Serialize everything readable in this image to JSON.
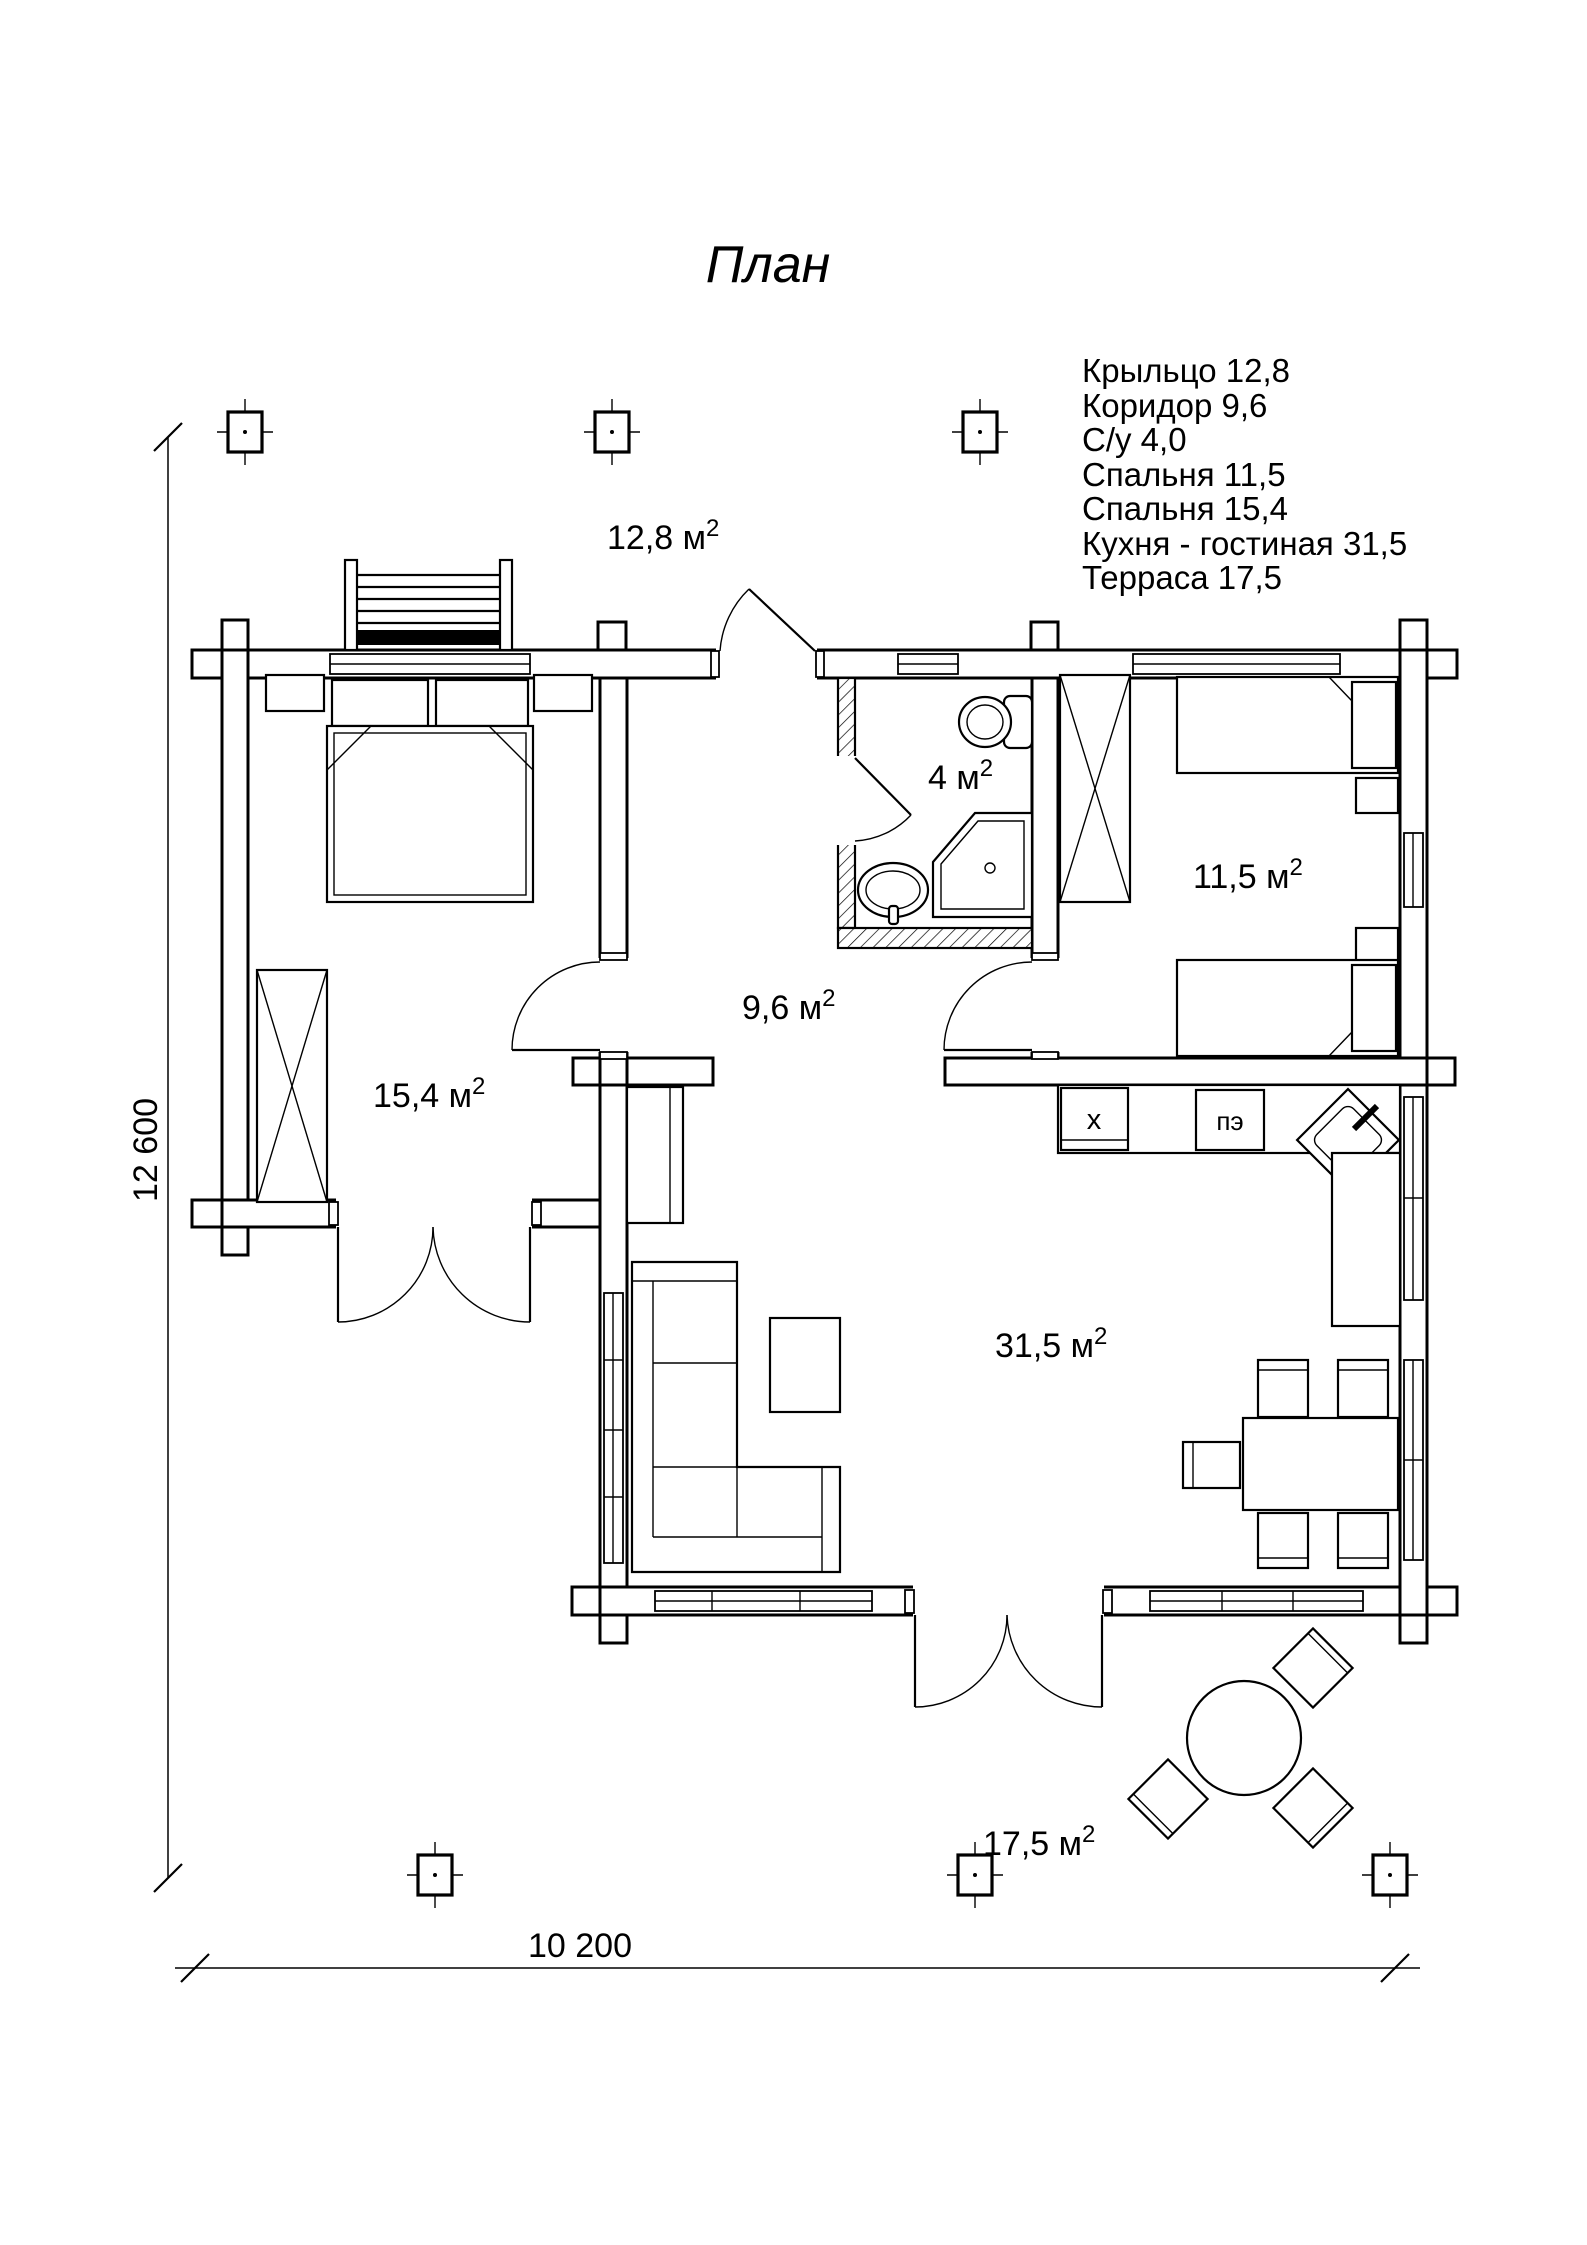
{
  "title": "План",
  "legend": {
    "items": [
      "Крыльцо 12,8",
      "Коридор 9,6",
      "С/у 4,0",
      "Спальня 11,5",
      "Спальня 15,4",
      "Кухня - гостиная 31,5",
      "Терраса 17,5"
    ]
  },
  "rooms": {
    "porch": {
      "label": "12,8 м",
      "sup": "2"
    },
    "bathroom": {
      "label": "4 м",
      "sup": "2"
    },
    "bedroom_small": {
      "label": "11,5 м",
      "sup": "2"
    },
    "corridor": {
      "label": "9,6 м",
      "sup": "2"
    },
    "bedroom_large": {
      "label": "15,4 м",
      "sup": "2"
    },
    "kitchen_living": {
      "label": "31,5 м",
      "sup": "2"
    },
    "terrace": {
      "label": "17,5 м",
      "sup": "2"
    }
  },
  "appliances": {
    "fridge": "х",
    "stove": "пэ"
  },
  "dimensions": {
    "width": "10 200",
    "height": "12 600"
  },
  "colors": {
    "line": "#000000",
    "background": "#ffffff"
  }
}
